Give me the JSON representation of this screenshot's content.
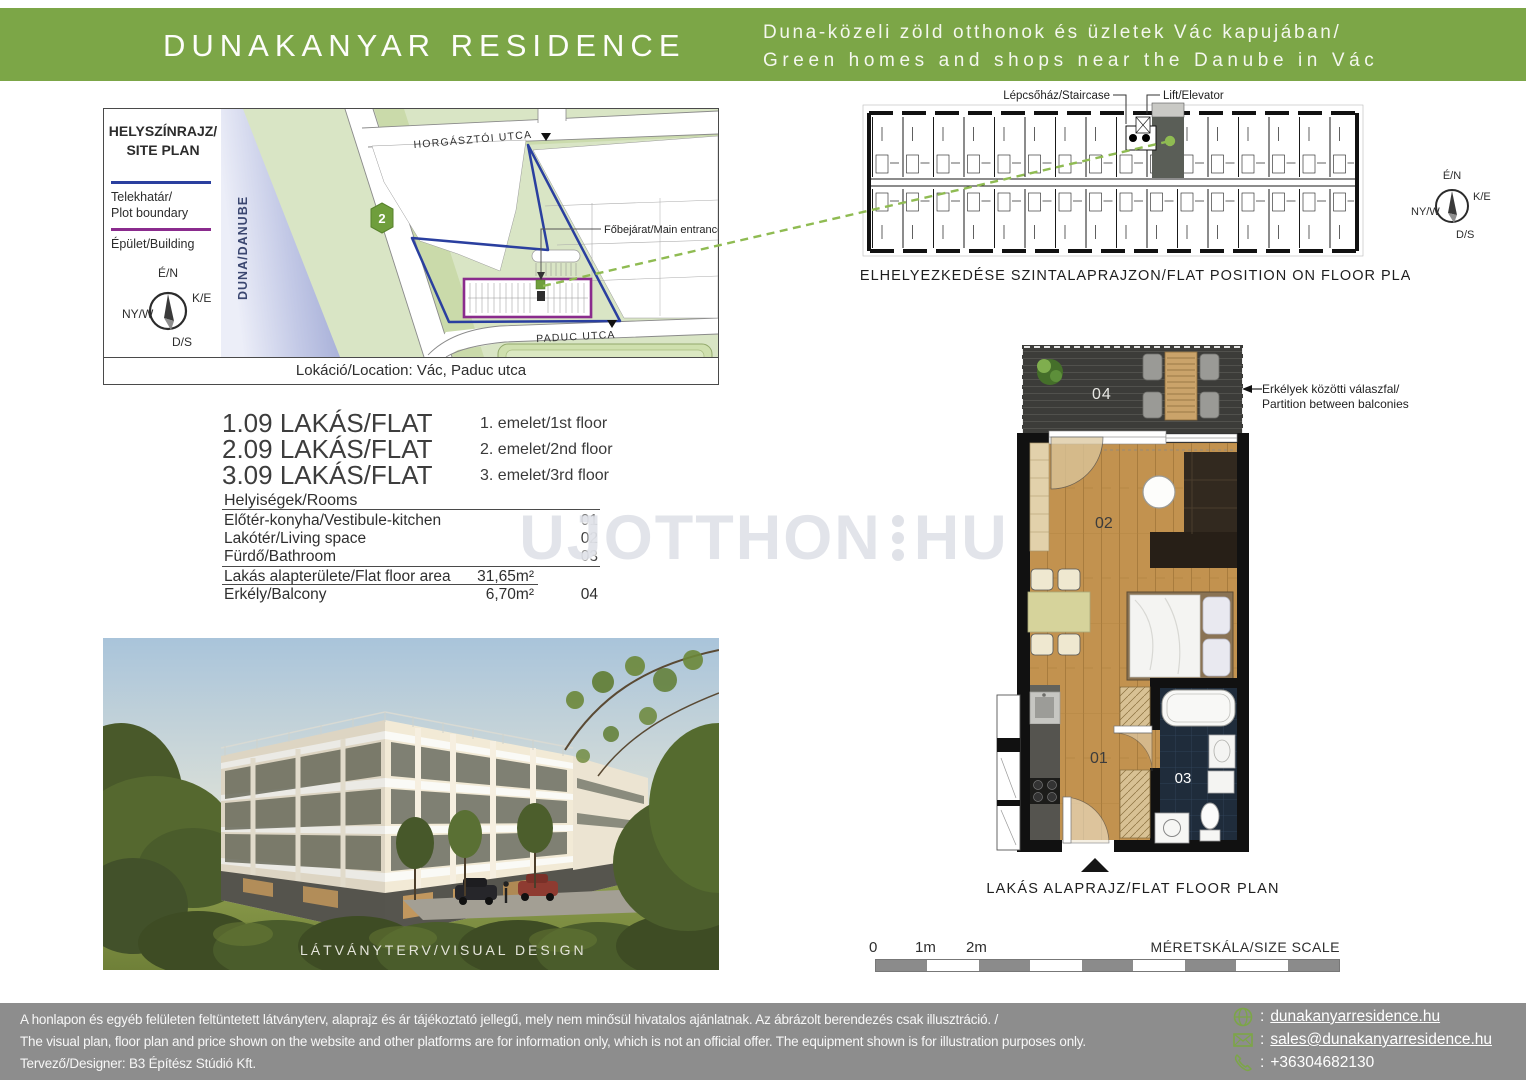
{
  "header": {
    "title": "DUNAKANYAR RESIDENCE",
    "tagline_hu": "Duna-közeli zöld otthonok és üzletek Vác kapujában/",
    "tagline_en": "Green homes and shops near the Danube in Vác"
  },
  "site_plan": {
    "title_line1": "HELYSZÍNRAJZ/",
    "title_line2": "SITE PLAN",
    "legend_plot_line1": "Telekhatár/",
    "legend_plot_line2": "Plot boundary",
    "legend_building": "Épület/Building",
    "compass": {
      "n": "É/N",
      "e": "K/E",
      "w": "NY/W",
      "s": "D/S"
    },
    "river_label": "DUNA/DANUBE",
    "road_badge": "2",
    "street_top": "HORGÁSZTÓI UTCA",
    "street_bottom": "PADUC UTCA",
    "entrance_label": "Főbejárat/Main entrance",
    "location_caption": "Lokáció/Location: Vác, Paduc utca"
  },
  "floor_strip": {
    "staircase_label": "Lépcsőház/Staircase",
    "elevator_label": "Lift/Elevator",
    "caption": "LAKÁS ELHELYEZKEDÉSE SZINTALAPRAJZON/FLAT POSITION ON FLOOR PLAN"
  },
  "flats": [
    {
      "name": "1.09 LAKÁS/FLAT",
      "floor": "1. emelet/1st floor"
    },
    {
      "name": "2.09 LAKÁS/FLAT",
      "floor": "2. emelet/2nd floor"
    },
    {
      "name": "3.09 LAKÁS/FLAT",
      "floor": "3. emelet/3rd floor"
    }
  ],
  "rooms": {
    "header": "Helyiségek/Rooms",
    "rows": [
      {
        "label": "Előtér-konyha/Vestibule-kitchen",
        "value": "",
        "code": "01"
      },
      {
        "label": "Lakótér/Living space",
        "value": "",
        "code": "02"
      },
      {
        "label": "Fürdő/Bathroom",
        "value": "",
        "code": "03"
      },
      {
        "label": "Lakás alapterülete/Flat floor area",
        "value": "31,65m²",
        "code": ""
      },
      {
        "label": "Erkély/Balcony",
        "value": "6,70m²",
        "code": "04"
      }
    ]
  },
  "watermark": {
    "part1": "UJOTTHON",
    "part2": "HU"
  },
  "flat_plan": {
    "caption": "LAKÁS ALAPRAJZ/FLAT FLOOR PLAN",
    "partition_note_line1": "Erkélyek közötti válaszfal/",
    "partition_note_line2": "Partition between balconies",
    "codes": {
      "vestibule": "01",
      "living": "02",
      "bathroom": "03",
      "balcony": "04"
    }
  },
  "visual": {
    "caption": "LÁTVÁNYTERV/VISUAL DESIGN"
  },
  "scale_bar": {
    "t0": "0",
    "t1": "1m",
    "t2": "2m",
    "caption": "MÉRETSKÁLA/SIZE SCALE"
  },
  "footer": {
    "disclaimer_hu": "A honlapon és egyéb felületen feltüntetett látványterv, alaprajz és ár tájékoztató jellegű, mely nem minősül hivatalos ajánlatnak. Az ábrázolt berendezés csak illusztráció. /",
    "disclaimer_en": "The visual plan, floor plan and price shown on the website and other platforms are for information only, which is not an official offer. The equipment shown is for illustration purposes only.",
    "designer": "Tervező/Designer: B3 Építész Stúdió Kft.",
    "sep": ":",
    "website": "dunakanyarresidence.hu",
    "email": "sales@dunakanyarresidence.hu",
    "phone": "+36304682130"
  },
  "colors": {
    "accent_green": "#7ca647",
    "plot_boundary_blue": "#2a3f9f",
    "building_purple": "#8a2b8d",
    "dashed_line_green": "#8fbb52",
    "footer_gray": "#8d8d8d"
  }
}
